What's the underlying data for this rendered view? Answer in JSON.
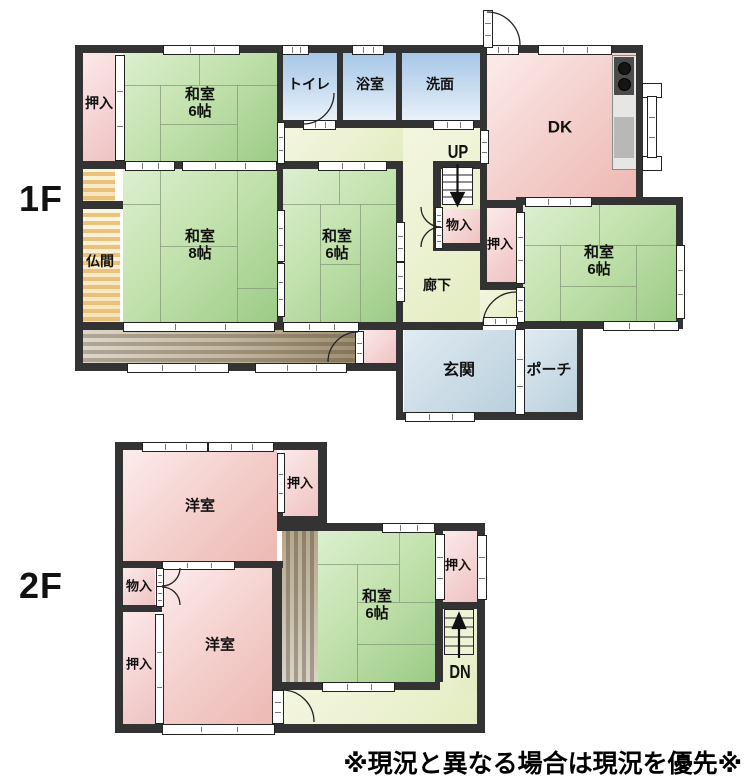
{
  "note": "※現況と異なる場合は現況を優先※",
  "floors": {
    "f1": {
      "label": "1F",
      "stairs": "UP",
      "rooms": {
        "oshiire_nw": "押入",
        "washitsu_nw": {
          "name": "和室",
          "size": "6帖"
        },
        "toilet": "トイレ",
        "bath": "浴室",
        "wash": "洗面",
        "dk": "DK",
        "butsuma": "仏間",
        "washitsu_8": {
          "name": "和室",
          "size": "8帖"
        },
        "washitsu_mid": {
          "name": "和室",
          "size": "6帖"
        },
        "monoire": "物入",
        "oshiire_e": "押入",
        "washitsu_ne": {
          "name": "和室",
          "size": "6帖"
        },
        "rouka": "廊下",
        "genkan": "玄関",
        "porch": "ポーチ"
      }
    },
    "f2": {
      "label": "2F",
      "stairs": "DN",
      "rooms": {
        "yoshitsu_n": "洋室",
        "oshiire_ne": "押入",
        "monoire": "物入",
        "oshiire_w": "押入",
        "yoshitsu_s": "洋室",
        "washitsu": {
          "name": "和室",
          "size": "6帖"
        },
        "oshiire_e": "押入"
      }
    }
  },
  "colors": {
    "wall": "#333333",
    "tatami_green": "#9ccb86",
    "room_pink": "#edb9b4",
    "sanitary_blue": "#a6c7e8",
    "entrance_blue": "#b9d0dd",
    "corridor_yellow_green": "#e3ecc1",
    "engawa_brown": "#9d8f73",
    "butsuma_tan": "#f7e3b6"
  }
}
